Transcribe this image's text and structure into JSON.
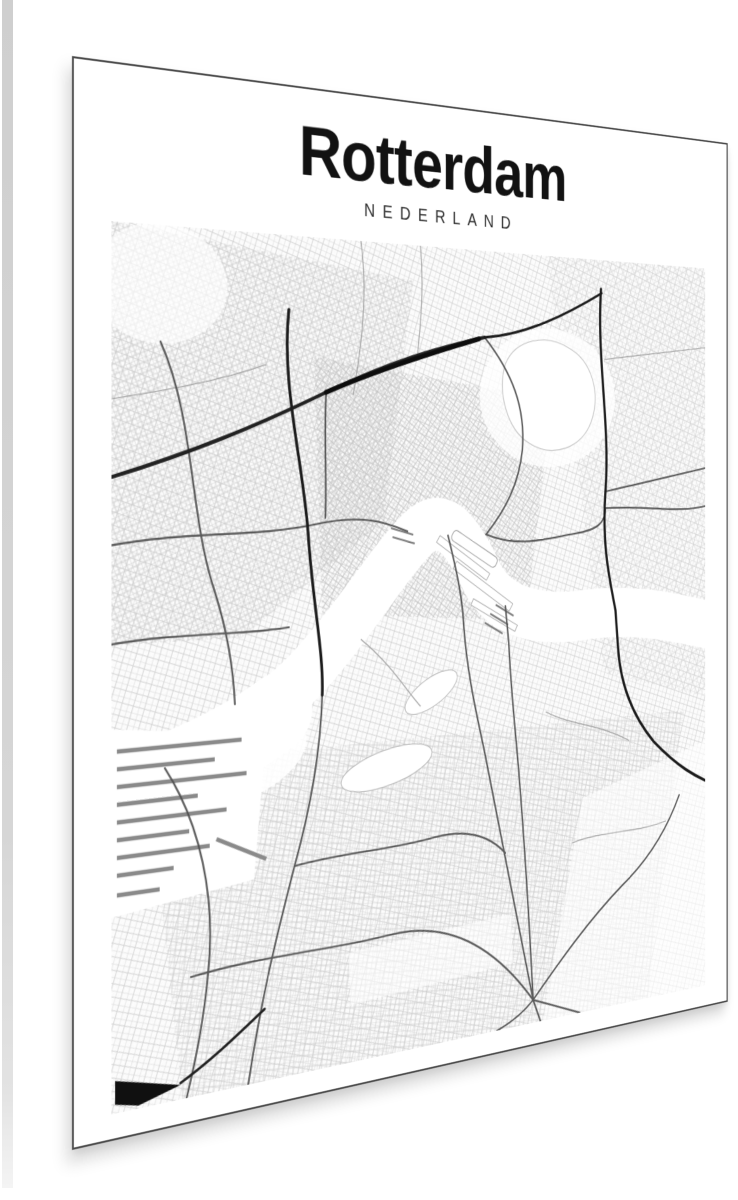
{
  "poster": {
    "title": "Rotterdam",
    "subtitle": "NEDERLAND"
  },
  "colors": {
    "background": "#ffffff",
    "page_edge_strip": "#d4d4d4",
    "poster_border": "#4a4a4a",
    "title_text": "#121212",
    "subtitle_text": "#2e2e2e",
    "road_dark": "#1c1c1c",
    "road_medium": "#4f4f4f",
    "street_texture": "#cfcfcf",
    "water_and_parks": "#ffffff"
  }
}
